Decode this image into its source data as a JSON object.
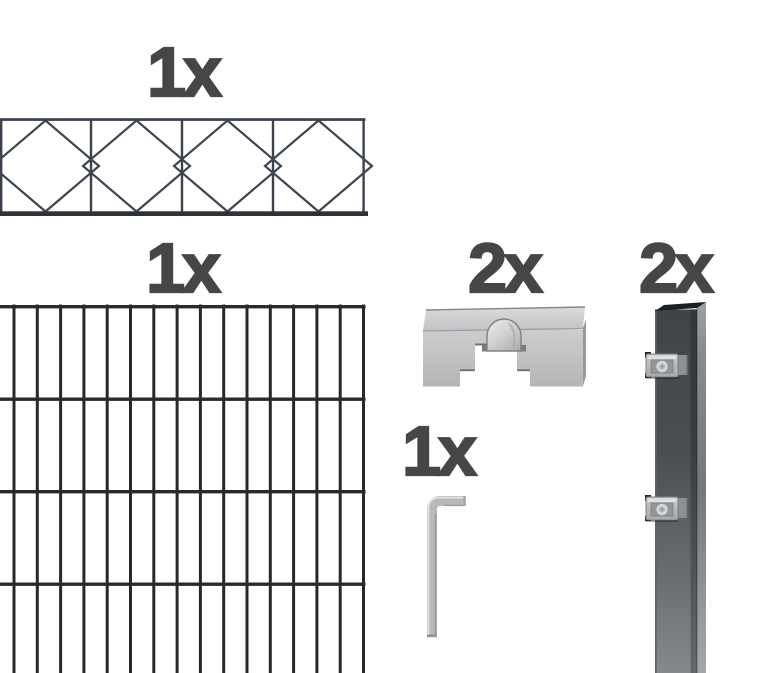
{
  "page": {
    "background": "#ffffff"
  },
  "labels": {
    "decor_panel_count": "1x",
    "mesh_panel_count": "1x",
    "cover_clamp_count": "2x",
    "hex_key_count": "1x",
    "post_count": "2x"
  },
  "colors": {
    "label_text": "#464644",
    "decor_wire": "#3f4551",
    "mesh_wire": "#26292b",
    "post_anthracite": "#43484c",
    "metal_silver": "#c6c7c9"
  }
}
